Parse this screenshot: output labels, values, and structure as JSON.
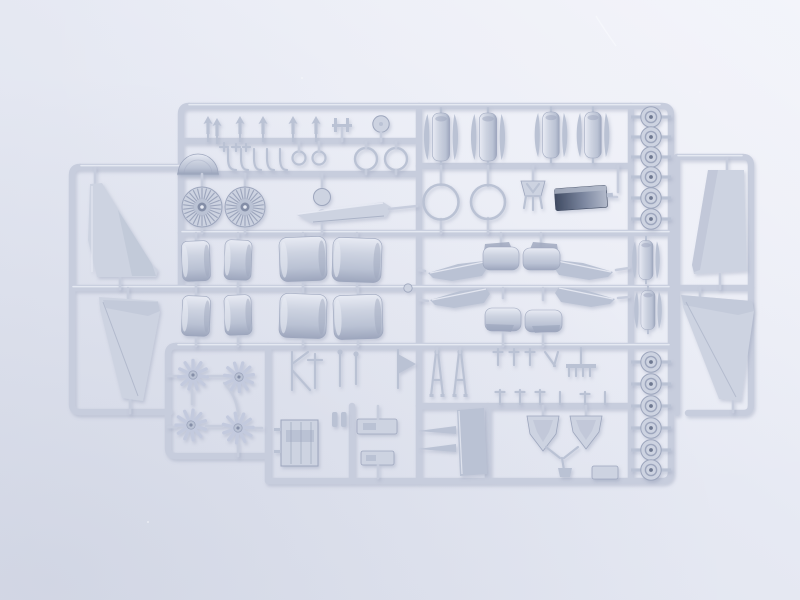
{
  "scene": {
    "description": "Overhead photograph of two overlapping light-grey injection-moulded styrene sprues (model aircraft kit part trees) lying on a pale cool blue-white surface under soft diffuse light",
    "subject": "plastic model kit sprues with unpainted aircraft parts",
    "sprue_color_name": "light grey styrene",
    "background_name": "pale blue-white seamless surface",
    "sprue_count": 2,
    "notable_parts": "four tail-fin halves, eight engine cowling barrel halves, two turbofan face discs, four multi-blade fan rotors, twelve wheels, mirrored swept wing-root fairings, one dark moulded equipment box, radome dome, rings, landing-gear struts and many small fittings"
  },
  "colors": {
    "bg-base": "#e6e9f3",
    "bg-light": "#f3f4fa",
    "bg-dark": "#dde1ed",
    "run": "#c7cddd",
    "run-hi": "#eaedf6",
    "part": "#cdd3e1",
    "part-hi": "#e8ebf4",
    "part-mid": "#bac2d4",
    "part-sh": "#9da6bd",
    "part-dk": "#848ea7",
    "hub": "#6e7890",
    "blade": "#c3cade",
    "box-dark": "#404b62",
    "box-mid": "#7c87a0",
    "box-light": "#b3bacb",
    "shadow": "#7e88a5",
    "scratch": "#f7f8fc"
  },
  "parts_inventory": [
    {
      "part": "vertical tail fin half",
      "count": 4
    },
    {
      "part": "turbofan engine face disc",
      "count": 2
    },
    {
      "part": "multi-blade fan rotor",
      "count": 4
    },
    {
      "part": "engine cowling barrel half",
      "count": 8
    },
    {
      "part": "cowl barrel with intake-lip crescents",
      "count": 6
    },
    {
      "part": "wheel with hub",
      "count": 12
    },
    {
      "part": "hoop ring large",
      "count": 2
    },
    {
      "part": "hoop ring medium",
      "count": 2
    },
    {
      "part": "hoop ring small",
      "count": 2
    },
    {
      "part": "radome half-dome",
      "count": 1
    },
    {
      "part": "dark moulded equipment box",
      "count": 1
    },
    {
      "part": "pitot aerial dart",
      "count": 6
    },
    {
      "part": "swept intake-lip strip",
      "count": 1
    },
    {
      "part": "wing-root fairing blade",
      "count": 4
    },
    {
      "part": "fairing cylinder section",
      "count": 4
    },
    {
      "part": "landing-gear A-frame strut",
      "count": 2
    },
    {
      "part": "arrowhead bracket",
      "count": 2
    },
    {
      "part": "Y-shaped link",
      "count": 1
    },
    {
      "part": "hatch louvre panel",
      "count": 1
    },
    {
      "part": "channel bracket",
      "count": 2
    },
    {
      "part": "tapered needle probe",
      "count": 2
    },
    {
      "part": "trapezoid panel",
      "count": 1
    },
    {
      "part": "small disc",
      "count": 3
    },
    {
      "part": "J-hook fitting",
      "count": 5
    },
    {
      "part": "assorted small fittings",
      "count": 24
    }
  ],
  "photo_artifacts": {
    "scratch": "faint bright diagonal scratch on backdrop, top centre-right",
    "dust": "a few tiny bright dust specks"
  }
}
